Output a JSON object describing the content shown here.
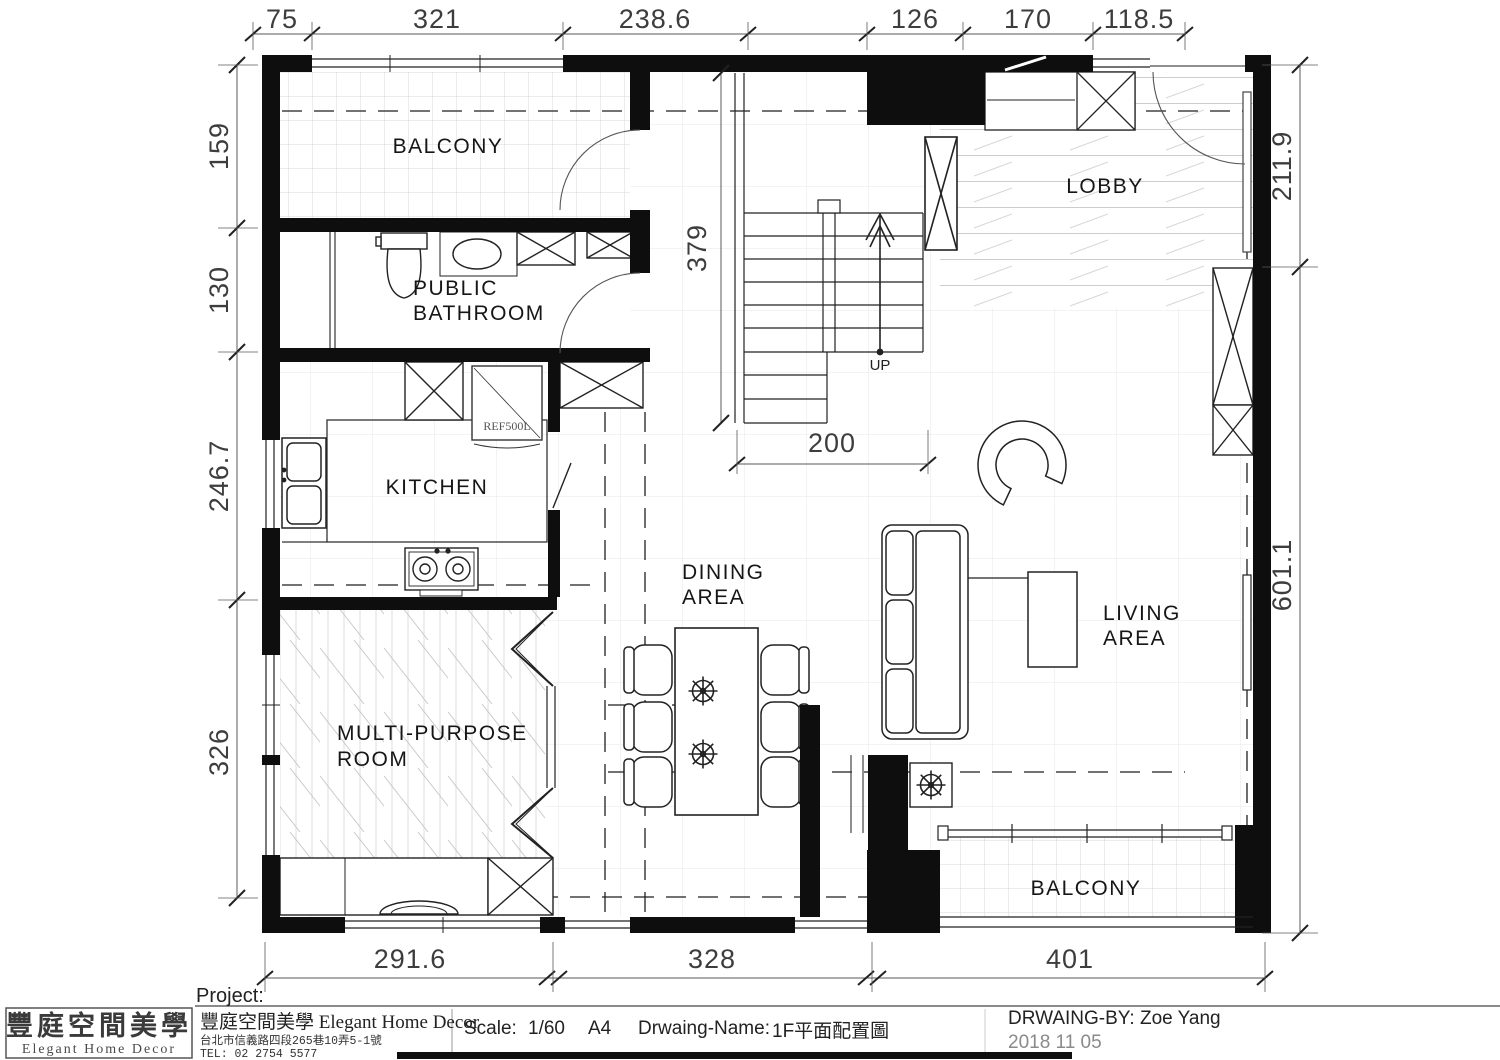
{
  "palette": {
    "ink": "#111111",
    "paper": "#ffffff",
    "hatch": "#cfcfcf",
    "dim": "#3d3d3d"
  },
  "rooms": {
    "balcony_top": "BALCONY",
    "bathroom_line1": "PUBLIC",
    "bathroom_line2": "BATHROOM",
    "lobby": "LOBBY",
    "kitchen": "KITCHEN",
    "dining_line1": "DINING",
    "dining_line2": "AREA",
    "living_line1": "LIVING",
    "living_line2": "AREA",
    "multi_line1": "MULTI-PURPOSE",
    "multi_line2": "ROOM",
    "balcony_bottom": "BALCONY"
  },
  "annotations": {
    "up": "UP",
    "fridge": "REF500L"
  },
  "dimensions": {
    "top": [
      "75",
      "321",
      "238.6",
      "126",
      "170",
      "118.5"
    ],
    "left": [
      "159",
      "130",
      "246.7",
      "326"
    ],
    "right": [
      "211.9",
      "601.1"
    ],
    "bottom": [
      "291.6",
      "328",
      "401"
    ],
    "stair_height": "379",
    "stair_width": "200"
  },
  "title_block": {
    "project_label": "Project:",
    "logo_cn": "豐庭空間美學",
    "logo_en": "Elegant Home Decor",
    "company_line": "豐庭空間美學 Elegant Home Decor",
    "address": "台北市信義路四段265巷10弄5-1號",
    "tel": "TEL:  02 2754 5577",
    "scale_label": "Scale:",
    "scale_value": "1/60",
    "paper_size": "A4",
    "drawing_name_label": "Drwaing-Name:",
    "drawing_name": "1F平面配置圖",
    "drawn_by": "DRWAING-BY:  Zoe  Yang",
    "date": "2018  11  05"
  }
}
